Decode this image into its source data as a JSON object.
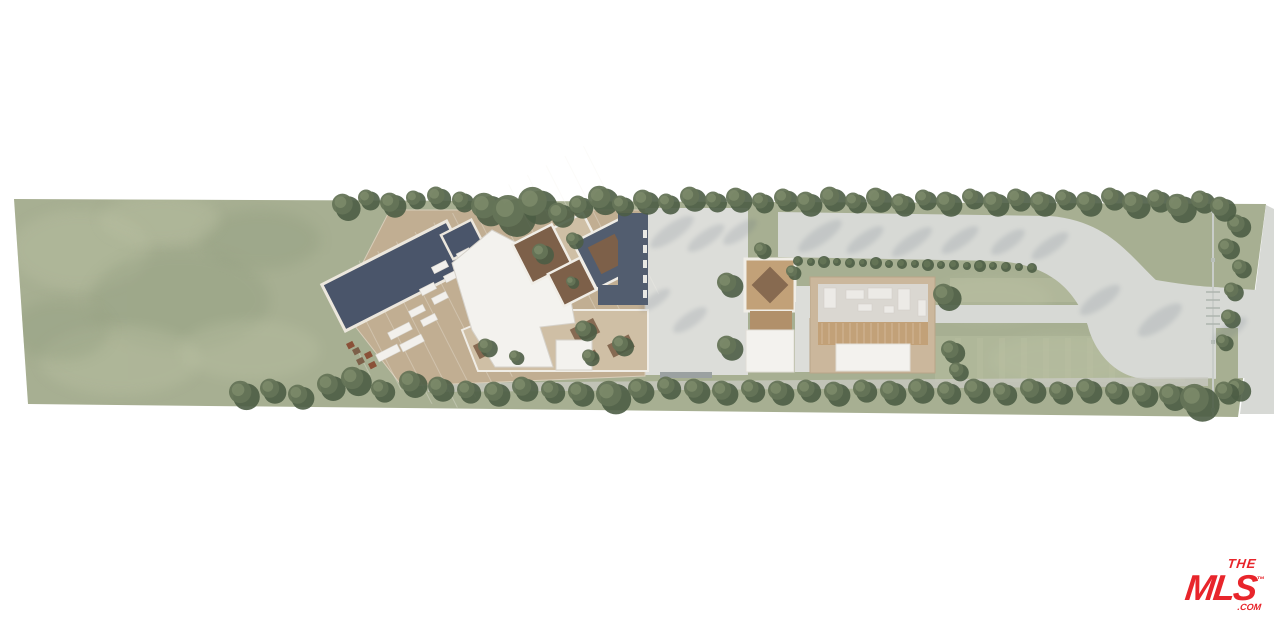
{
  "logo": {
    "the": "THE",
    "mls": "MLS",
    "tm": "™",
    "com": ".COM",
    "color": "#e8252b"
  },
  "palette": {
    "bg": "#ffffff",
    "lawn": "#a7af92",
    "lawn_light": "#bcc2a4",
    "lawn_dark": "#909c7e",
    "tree_dark": "#4d5d45",
    "tree_mid": "#657457",
    "tree_light": "#7e8c6c",
    "pool": "#4a556a",
    "deck": "#c1ae92",
    "deck_light": "#cfbfa5",
    "roof_white": "#f3f2ee",
    "roof_dark": "#525d6f",
    "concrete": "#dcddd9",
    "drive": "#d7d9d5",
    "path": "#c9cac3",
    "wood": "#c2a178",
    "wood_dark": "#b1906a",
    "soil": "#7d6049",
    "wall": "#cbb79c",
    "floor": "#dad7d1",
    "furniture": "#eceae6",
    "shadow": "#5f6a7c",
    "fence": "#c9cdc9"
  },
  "vegetation": {
    "top_row": [
      [
        345,
        206,
        13
      ],
      [
        368,
        199,
        10
      ],
      [
        392,
        204,
        12
      ],
      [
        415,
        199,
        9
      ],
      [
        438,
        197,
        11
      ],
      [
        462,
        201,
        10
      ],
      [
        487,
        208,
        16
      ],
      [
        512,
        214,
        20
      ],
      [
        536,
        204,
        18
      ],
      [
        560,
        214,
        12
      ],
      [
        580,
        206,
        11
      ],
      [
        602,
        199,
        14
      ],
      [
        622,
        205,
        10
      ],
      [
        645,
        201,
        12
      ],
      [
        668,
        203,
        10
      ],
      [
        692,
        198,
        12
      ],
      [
        715,
        201,
        10
      ],
      [
        738,
        199,
        12
      ],
      [
        762,
        202,
        10
      ],
      [
        785,
        199,
        11
      ],
      [
        808,
        203,
        12
      ],
      [
        832,
        198,
        12
      ],
      [
        855,
        202,
        10
      ],
      [
        878,
        199,
        12
      ],
      [
        902,
        204,
        11
      ],
      [
        925,
        199,
        10
      ],
      [
        948,
        203,
        12
      ],
      [
        972,
        198,
        10
      ],
      [
        995,
        203,
        12
      ],
      [
        1018,
        199,
        11
      ],
      [
        1042,
        203,
        12
      ],
      [
        1065,
        199,
        10
      ],
      [
        1088,
        203,
        12
      ],
      [
        1112,
        198,
        11
      ],
      [
        1135,
        204,
        13
      ],
      [
        1158,
        200,
        11
      ],
      [
        1180,
        207,
        14
      ],
      [
        1202,
        201,
        11
      ],
      [
        1222,
        208,
        12
      ]
    ],
    "bottom_row": [
      [
        243,
        394,
        14
      ],
      [
        272,
        390,
        12
      ],
      [
        300,
        396,
        12
      ],
      [
        330,
        386,
        13
      ],
      [
        355,
        380,
        14
      ],
      [
        382,
        390,
        11
      ],
      [
        412,
        383,
        13
      ],
      [
        440,
        388,
        12
      ],
      [
        468,
        391,
        11
      ],
      [
        496,
        393,
        12
      ],
      [
        524,
        388,
        12
      ],
      [
        552,
        391,
        11
      ],
      [
        580,
        393,
        12
      ],
      [
        612,
        396,
        16
      ],
      [
        640,
        390,
        12
      ],
      [
        668,
        387,
        11
      ],
      [
        696,
        390,
        12
      ],
      [
        724,
        392,
        12
      ],
      [
        752,
        390,
        11
      ],
      [
        780,
        392,
        12
      ],
      [
        808,
        390,
        11
      ],
      [
        836,
        393,
        12
      ],
      [
        864,
        390,
        11
      ],
      [
        892,
        392,
        12
      ],
      [
        920,
        390,
        12
      ],
      [
        948,
        392,
        11
      ],
      [
        976,
        390,
        12
      ],
      [
        1004,
        393,
        11
      ],
      [
        1032,
        390,
        12
      ],
      [
        1060,
        392,
        11
      ],
      [
        1088,
        390,
        12
      ],
      [
        1116,
        392,
        11
      ],
      [
        1144,
        394,
        12
      ],
      [
        1172,
        396,
        13
      ],
      [
        1198,
        401,
        18
      ],
      [
        1226,
        392,
        11
      ]
    ],
    "accent_trees": [
      [
        542,
        253,
        10
      ],
      [
        574,
        240,
        8
      ],
      [
        572,
        282,
        6
      ],
      [
        585,
        330,
        10
      ],
      [
        622,
        345,
        10
      ],
      [
        590,
        357,
        8
      ],
      [
        487,
        347,
        9
      ],
      [
        516,
        357,
        7
      ],
      [
        762,
        250,
        8
      ],
      [
        729,
        284,
        12
      ],
      [
        729,
        347,
        12
      ],
      [
        946,
        296,
        13
      ],
      [
        952,
        351,
        11
      ],
      [
        958,
        371,
        9
      ],
      [
        793,
        272,
        7
      ],
      [
        1238,
        225,
        11
      ],
      [
        1228,
        248,
        10
      ],
      [
        1241,
        268,
        9
      ],
      [
        1233,
        291,
        9
      ],
      [
        1230,
        318,
        9
      ],
      [
        1224,
        342,
        8
      ],
      [
        1238,
        389,
        11
      ]
    ],
    "hedge": [
      [
        798,
        261,
        5
      ],
      [
        811,
        262,
        4
      ],
      [
        824,
        262,
        6
      ],
      [
        837,
        262,
        4
      ],
      [
        850,
        263,
        5
      ],
      [
        863,
        263,
        4
      ],
      [
        876,
        263,
        6
      ],
      [
        889,
        264,
        4
      ],
      [
        902,
        264,
        5
      ],
      [
        915,
        264,
        4
      ],
      [
        928,
        265,
        6
      ],
      [
        941,
        265,
        4
      ],
      [
        954,
        265,
        5
      ],
      [
        967,
        266,
        4
      ],
      [
        980,
        266,
        6
      ],
      [
        993,
        266,
        4
      ],
      [
        1006,
        267,
        5
      ],
      [
        1019,
        267,
        4
      ],
      [
        1032,
        268,
        5
      ]
    ]
  },
  "lawn_patches": [
    [
      80,
      250,
      70,
      40,
      "light"
    ],
    [
      180,
      300,
      90,
      50,
      "dark"
    ],
    [
      120,
      360,
      80,
      35,
      "light"
    ],
    [
      260,
      240,
      60,
      30,
      "dark"
    ],
    [
      60,
      330,
      50,
      30,
      "dark"
    ],
    [
      250,
      350,
      70,
      30,
      "light"
    ],
    [
      160,
      220,
      60,
      25,
      "light"
    ],
    [
      990,
      300,
      60,
      22,
      "light"
    ],
    [
      1060,
      360,
      70,
      24,
      "light"
    ]
  ],
  "pool_loungers": [
    [
      440,
      267,
      16,
      7
    ],
    [
      452,
      276,
      16,
      7
    ],
    [
      428,
      289,
      16,
      7
    ],
    [
      440,
      298,
      16,
      7
    ],
    [
      417,
      311,
      16,
      7
    ],
    [
      429,
      320,
      16,
      7
    ],
    [
      464,
      254,
      14,
      7
    ],
    [
      476,
      263,
      14,
      7
    ],
    [
      400,
      331,
      24,
      8
    ],
    [
      412,
      343,
      24,
      8
    ],
    [
      388,
      353,
      24,
      8
    ]
  ],
  "terrace_boxes": [
    [
      352,
      350
    ],
    [
      364,
      354
    ],
    [
      356,
      360
    ],
    [
      368,
      364
    ],
    [
      376,
      356
    ],
    [
      346,
      344
    ]
  ],
  "planters": [
    [
      585,
      331,
      26,
      16
    ],
    [
      621,
      346,
      24,
      14
    ],
    [
      589,
      358,
      18,
      10
    ],
    [
      487,
      347,
      24,
      15
    ],
    [
      516,
      357,
      22,
      12
    ]
  ],
  "guest_furniture": [
    [
      824,
      288,
      12,
      20
    ],
    [
      846,
      290,
      18,
      9
    ],
    [
      868,
      288,
      24,
      11
    ],
    [
      898,
      289,
      12,
      21
    ],
    [
      858,
      304,
      14,
      7
    ],
    [
      884,
      306,
      10,
      7
    ],
    [
      918,
      300,
      8,
      16
    ]
  ],
  "shadow_streaks": [
    [
      672,
      232,
      26,
      8
    ],
    [
      706,
      238,
      22,
      7
    ],
    [
      740,
      232,
      20,
      7
    ],
    [
      820,
      236,
      26,
      8
    ],
    [
      865,
      240,
      22,
      7
    ],
    [
      912,
      242,
      24,
      7
    ],
    [
      960,
      240,
      22,
      7
    ],
    [
      1008,
      242,
      20,
      7
    ],
    [
      1050,
      246,
      22,
      7
    ],
    [
      1100,
      300,
      24,
      8
    ],
    [
      1160,
      320,
      26,
      9
    ],
    [
      1230,
      330,
      20,
      7
    ],
    [
      655,
      300,
      18,
      6
    ],
    [
      690,
      320,
      20,
      7
    ]
  ]
}
